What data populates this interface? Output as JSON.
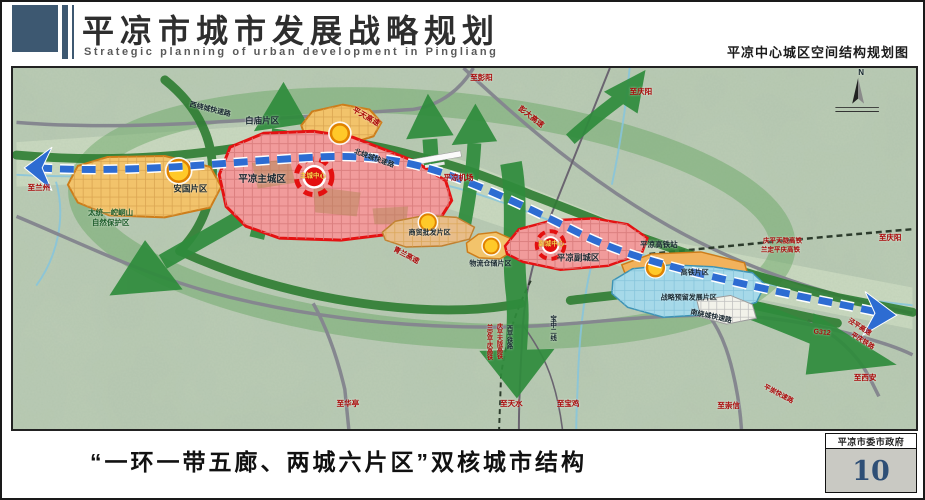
{
  "header": {
    "title_cn": "平凉市城市发展战略规划",
    "title_en": "Strategic planning of urban development in Pingliang",
    "sheet_title": "平凉中心城区空间结构规划图"
  },
  "footer": {
    "caption": "“一环一带五廊、两城六片区”双核城市结构",
    "agency": "平凉市委市政府",
    "page_number": "10"
  },
  "colors": {
    "accent_red": "#e41010",
    "zone_pink": "#f19b9b",
    "zone_orange": "#f2c36b",
    "zone_blue": "#a6d9e9",
    "axis_blue": "#2d6cd2",
    "corridor_green": "#2f8c3c",
    "header_slate": "#3d5871",
    "page_number_blue": "#2e4f76"
  },
  "map": {
    "compass": "N",
    "labels": [
      {
        "text": "至兰州",
        "cls": "red",
        "x": 26,
        "y": 121
      },
      {
        "text": "至彭阳",
        "cls": "red",
        "x": 470,
        "y": 10
      },
      {
        "text": "至庆阳",
        "cls": "red",
        "x": 630,
        "y": 24
      },
      {
        "text": "彭大高速",
        "cls": "red",
        "x": 520,
        "y": 50,
        "r": 38
      },
      {
        "text": "平天高速",
        "cls": "red",
        "x": 354,
        "y": 50,
        "r": 30
      },
      {
        "text": "西绕城快速路",
        "cls": "dark",
        "x": 198,
        "y": 42,
        "r": 14,
        "s": 7
      },
      {
        "text": "北绕城快速路",
        "cls": "dark",
        "x": 362,
        "y": 92,
        "r": 20,
        "s": 7
      },
      {
        "text": "平凉机场",
        "cls": "red",
        "x": 447,
        "y": 111
      },
      {
        "text": "白庙片区",
        "cls": "dark",
        "x": 250,
        "y": 54,
        "s": 8.5
      },
      {
        "text": "平凉主城区",
        "cls": "dark",
        "x": 250,
        "y": 113,
        "s": 9.5
      },
      {
        "text": "主城中心",
        "cls": "gold",
        "x": 301,
        "y": 110,
        "s": 6.5
      },
      {
        "text": "安国片区",
        "cls": "dark",
        "x": 178,
        "y": 122,
        "s": 8.5
      },
      {
        "text": "太统—崆峒山",
        "cls": "green",
        "x": 98,
        "y": 147,
        "s": 7.5
      },
      {
        "text": "自然保护区",
        "cls": "green",
        "x": 98,
        "y": 157,
        "s": 7.5
      },
      {
        "text": "青兰高速",
        "cls": "red",
        "x": 394,
        "y": 190,
        "r": 28,
        "s": 7
      },
      {
        "text": "商贸批发片区",
        "cls": "dark",
        "x": 418,
        "y": 167,
        "s": 7
      },
      {
        "text": "物流仓储片区",
        "cls": "dark",
        "x": 479,
        "y": 198,
        "s": 7
      },
      {
        "text": "副城中心",
        "cls": "gold",
        "x": 540,
        "y": 179,
        "s": 6.5
      },
      {
        "text": "平凉副城区",
        "cls": "dark",
        "x": 567,
        "y": 192,
        "s": 8.5
      },
      {
        "text": "平凉高铁站",
        "cls": "dark",
        "x": 648,
        "y": 179,
        "s": 7.5
      },
      {
        "text": "高铁片区",
        "cls": "dark",
        "x": 684,
        "y": 207,
        "s": 7
      },
      {
        "text": "战略预留发展片区",
        "cls": "dark",
        "x": 678,
        "y": 233,
        "s": 7
      },
      {
        "text": "庆平天陇高铁",
        "cls": "red",
        "x": 772,
        "y": 176,
        "s": 6.5
      },
      {
        "text": "兰定平庆高铁",
        "cls": "red",
        "x": 770,
        "y": 185,
        "s": 6.5
      },
      {
        "text": "至庆阳",
        "cls": "red",
        "x": 880,
        "y": 172
      },
      {
        "text": "南绕城快速路",
        "cls": "dark",
        "x": 700,
        "y": 252,
        "r": 12,
        "s": 7
      },
      {
        "text": "G312",
        "cls": "red",
        "x": 812,
        "y": 268,
        "r": 6,
        "s": 7
      },
      {
        "text": "泾平高速",
        "cls": "red",
        "x": 849,
        "y": 263,
        "r": 32,
        "s": 6.5
      },
      {
        "text": "平庆铁路",
        "cls": "red",
        "x": 852,
        "y": 277,
        "r": 32,
        "s": 6.5
      },
      {
        "text": "至西安",
        "cls": "red",
        "x": 855,
        "y": 313
      },
      {
        "text": "至崇信",
        "cls": "red",
        "x": 718,
        "y": 342
      },
      {
        "text": "平崇快速路",
        "cls": "red",
        "x": 768,
        "y": 331,
        "r": 28,
        "s": 6.5
      },
      {
        "text": "至华亭",
        "cls": "red",
        "x": 336,
        "y": 340
      },
      {
        "text": "至天水",
        "cls": "red",
        "x": 500,
        "y": 340
      },
      {
        "text": "至宝鸡",
        "cls": "red",
        "x": 557,
        "y": 340
      },
      {
        "text": "兰定平庆高铁",
        "cls": "red",
        "x": 477,
        "y": 277,
        "v": true,
        "s": 6
      },
      {
        "text": "庆平天陇高铁",
        "cls": "red",
        "x": 487,
        "y": 276,
        "v": true,
        "s": 6
      },
      {
        "text": "西平铁路",
        "cls": "dark",
        "x": 497,
        "y": 272,
        "v": true,
        "s": 6
      },
      {
        "text": "宝中二线",
        "cls": "dark",
        "x": 540,
        "y": 263,
        "v": true,
        "s": 6.5
      },
      {
        "text": "N",
        "cls": "dark",
        "x": 851,
        "y": 5,
        "s": 8
      }
    ]
  }
}
